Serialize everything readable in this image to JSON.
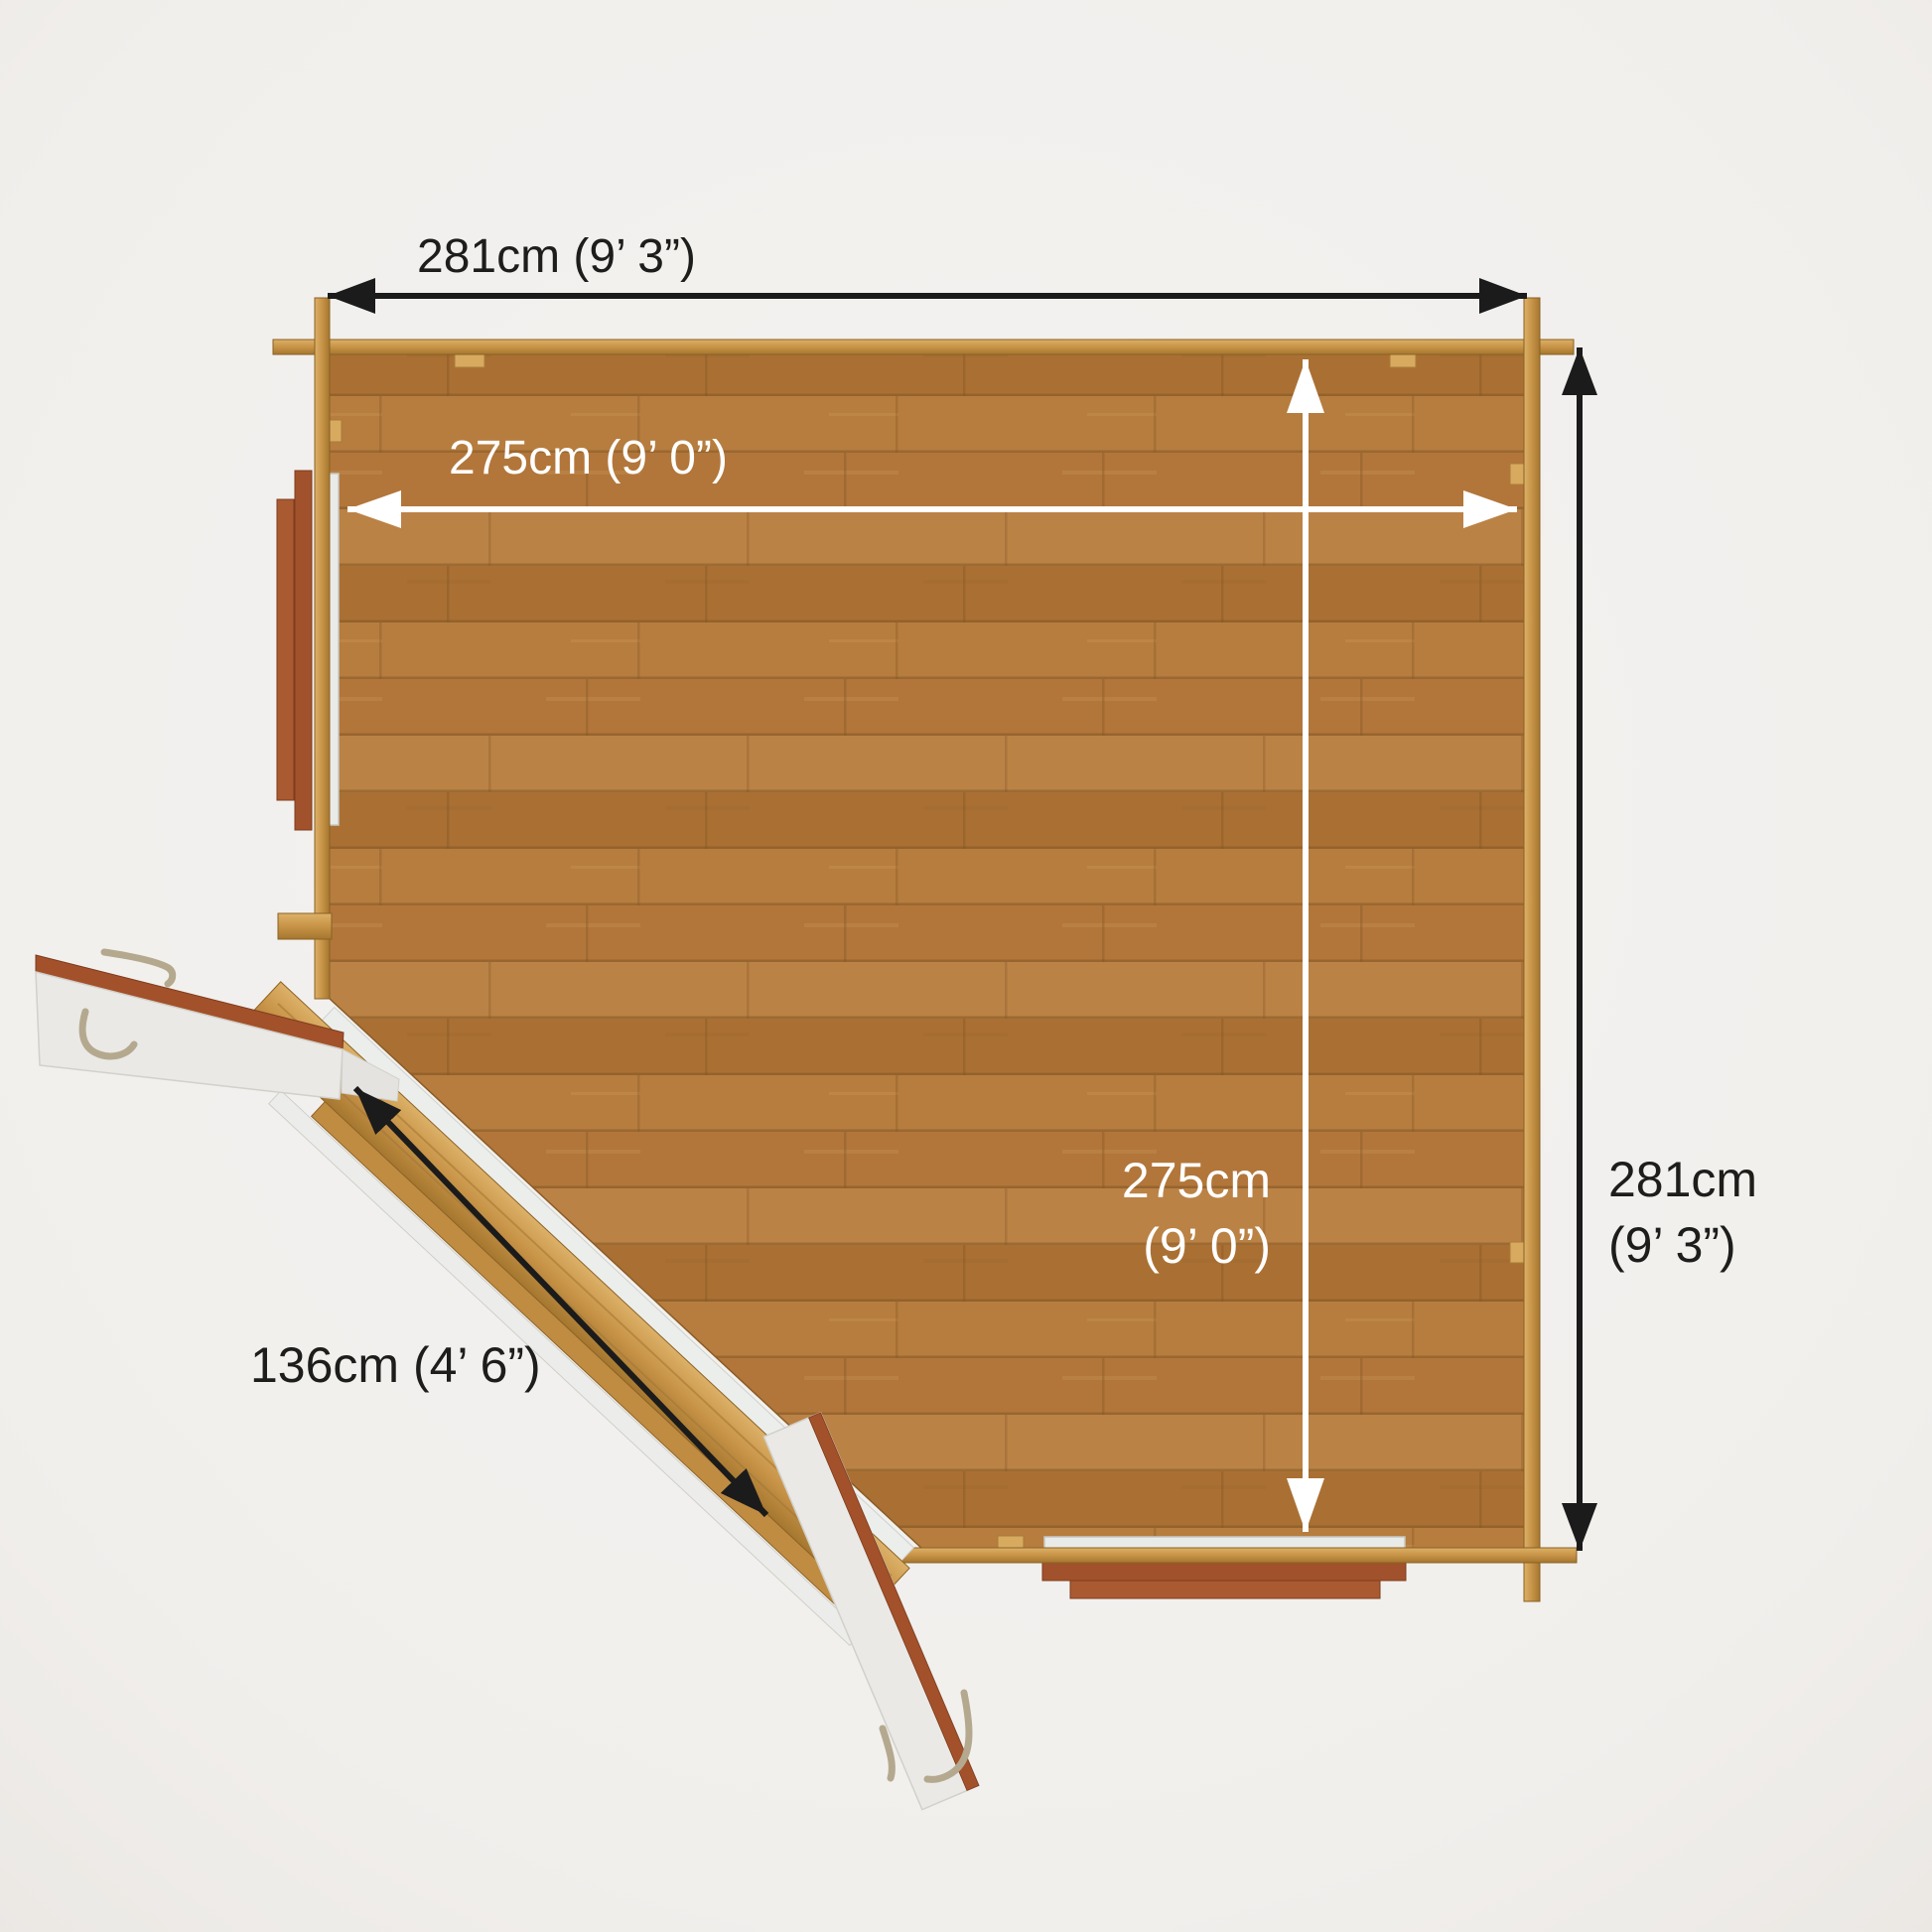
{
  "scene": {
    "background_color": "#f1efec",
    "floor_wood_color": "#b3783a",
    "wall_wood_color": "#c79347",
    "window_sill_color": "#a1522c",
    "window_glass_color": "#e9ebe8",
    "door_panel_color": "#eae9e5",
    "door_edge_color": "#a3512a",
    "handle_metal_color": "#b4a98f",
    "arrow_dark": "#1b1b1b",
    "arrow_light": "#ffffff",
    "label_dark": "#1d1d1b",
    "label_light": "#ffffff"
  },
  "dimensions": {
    "outer_width": "281cm (9’ 3”)",
    "inner_width": "275cm  (9’ 0”)",
    "inner_depth_line1": "275cm",
    "inner_depth_line2": "(9’ 0”)",
    "outer_depth_line1": "281cm",
    "outer_depth_line2": "(9’ 3”)",
    "door_width": "136cm  (4’ 6”)"
  }
}
